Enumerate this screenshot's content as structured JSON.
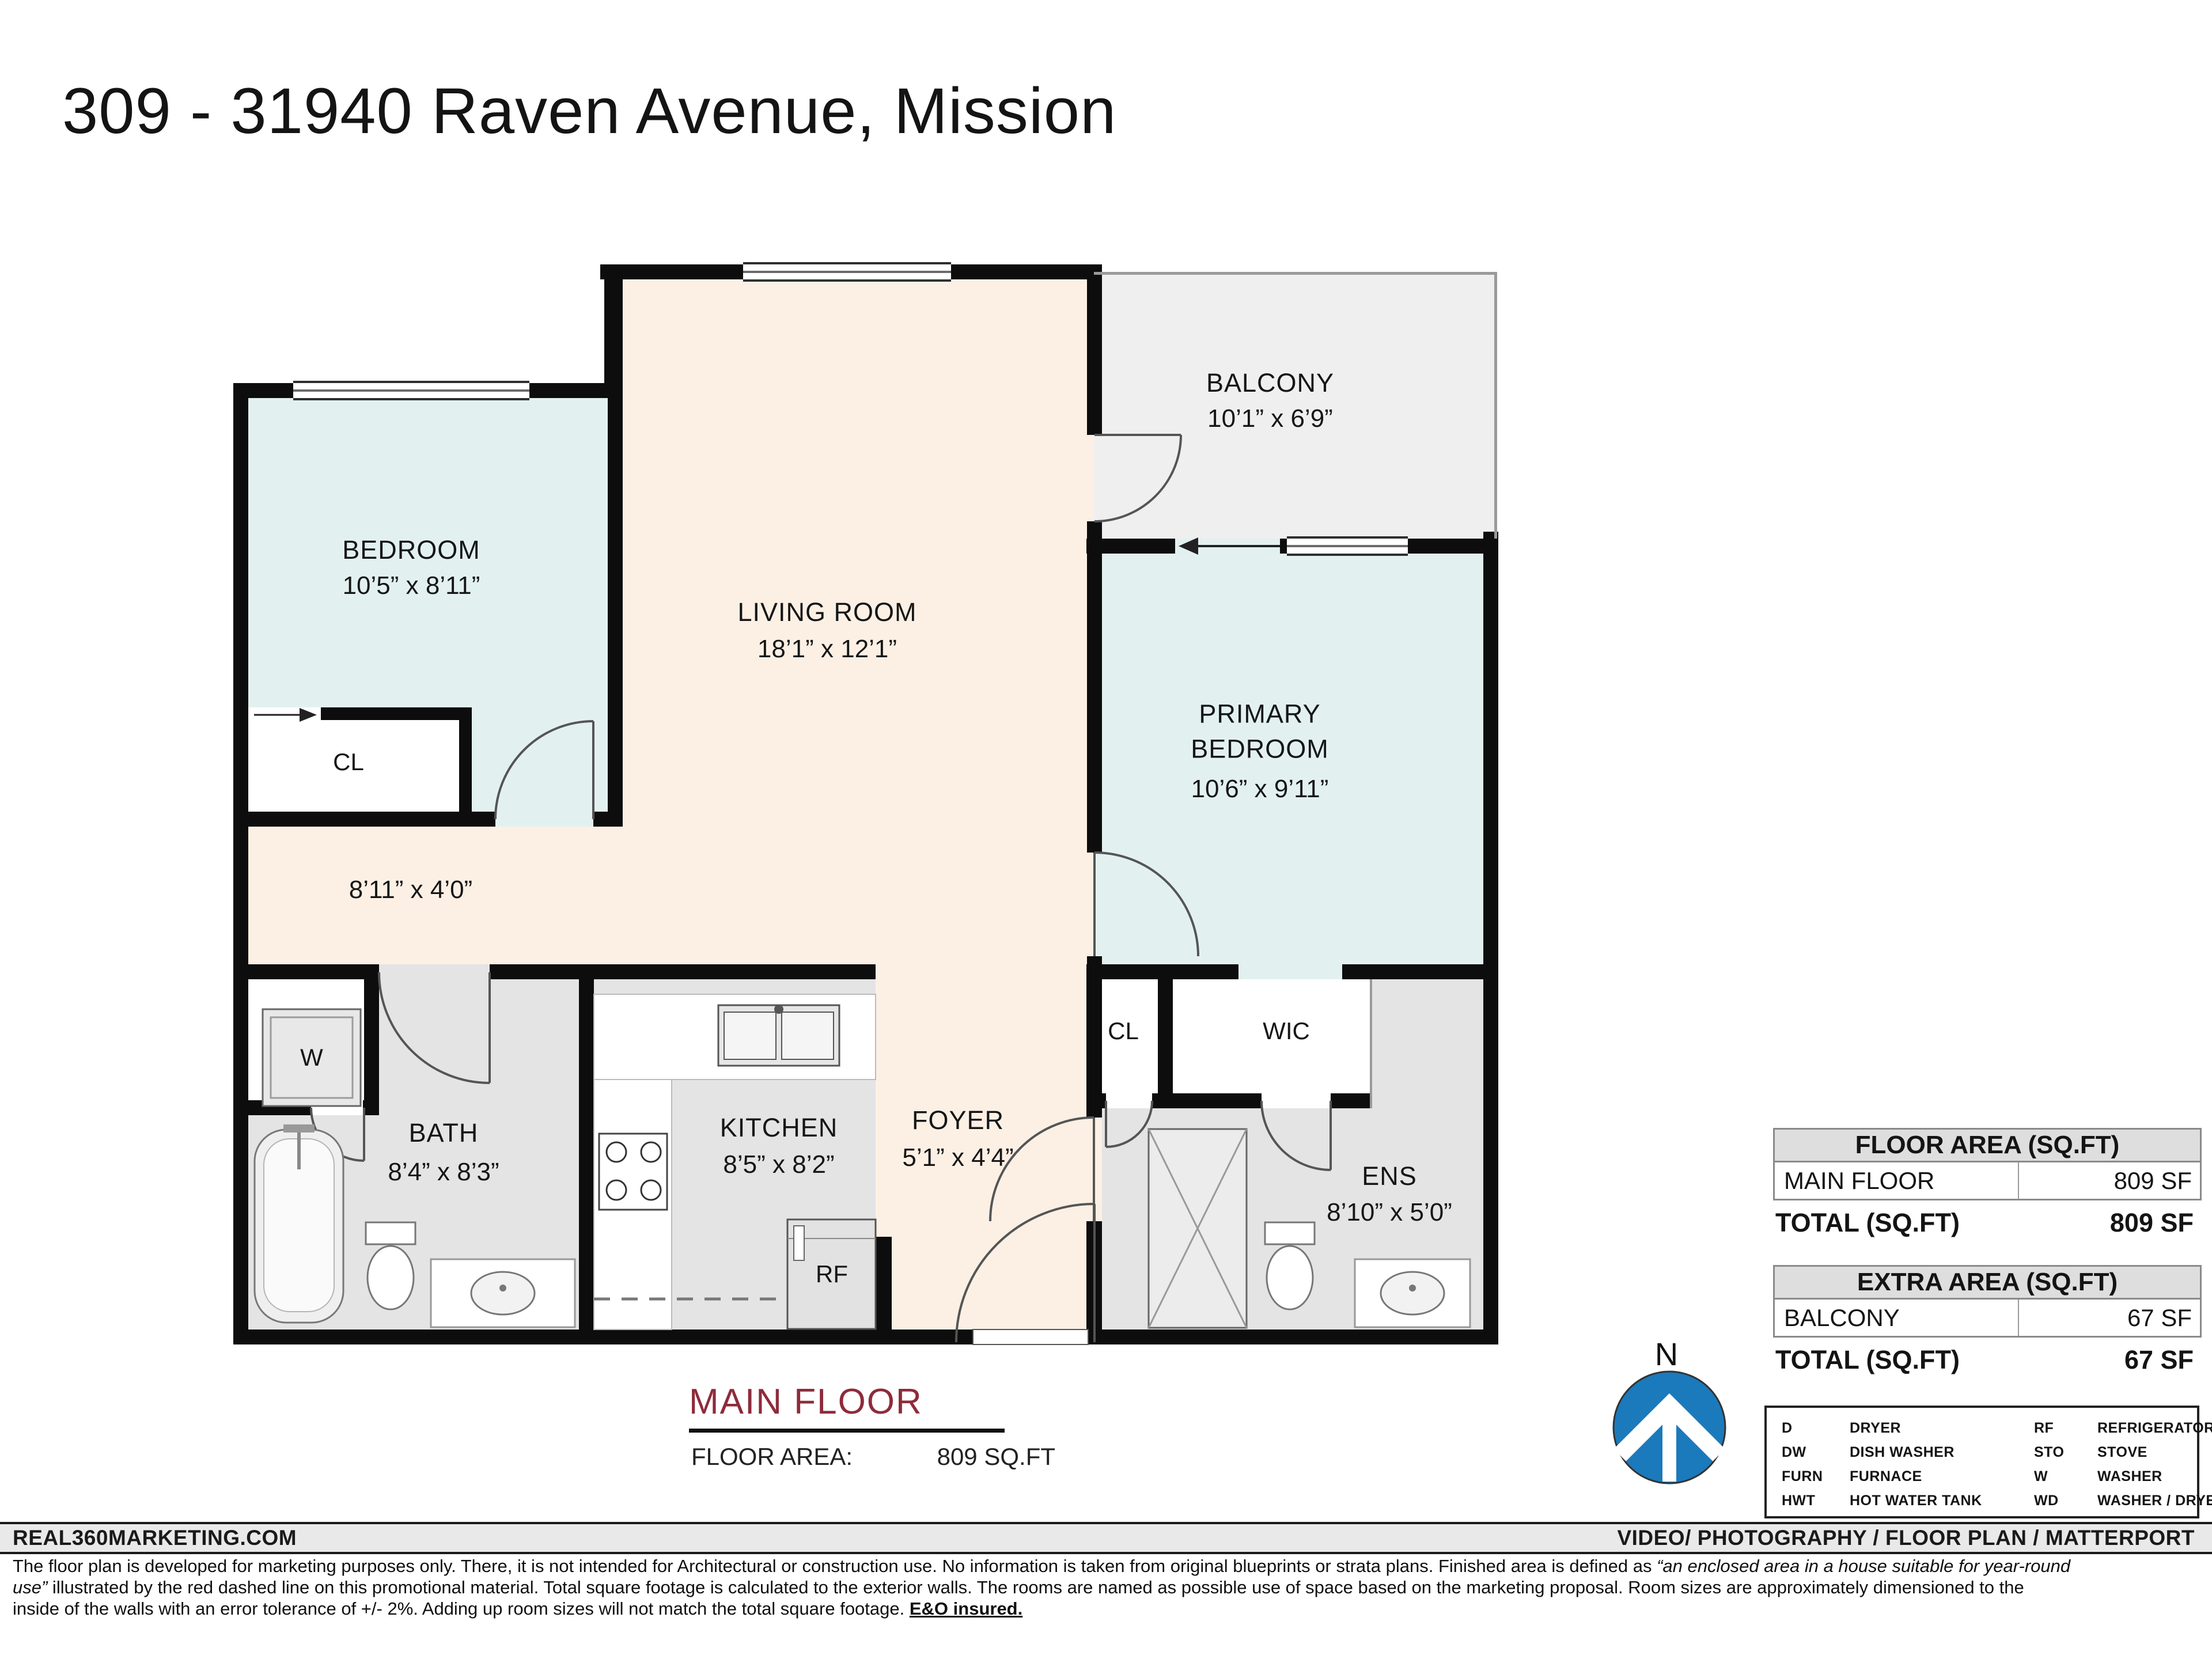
{
  "title": "309 - 31940 Raven  Avenue, Mission",
  "plan": {
    "rooms": [
      {
        "label": "BEDROOM",
        "dims": "10’5” x 8’11”"
      },
      {
        "label": "LIVING ROOM",
        "dims": "18’1” x 12’1”"
      },
      {
        "label": "BALCONY",
        "dims": "10’1” x 6’9”"
      },
      {
        "label": "PRIMARY BEDROOM",
        "dims": "10’6” x 9’11”"
      },
      {
        "label": "BATH",
        "dims": "8’4” x 8’3”"
      },
      {
        "label": "KITCHEN",
        "dims": "8’5” x 8’2”"
      },
      {
        "label": "FOYER",
        "dims": "5’1” x 4’4”"
      },
      {
        "label": "ENS",
        "dims": "8’10” x 5’0”"
      },
      {
        "label": "",
        "dims": "8’11” x 4’0”"
      }
    ],
    "small_labels": {
      "cl1": "CL",
      "cl2": "CL",
      "wic": "WIC",
      "washer": "W",
      "fridge": "RF"
    }
  },
  "floor_summary": {
    "name": "MAIN FLOOR",
    "area_label": "FLOOR AREA:",
    "area_value": "809 SQ.FT"
  },
  "area_tables": [
    {
      "header": "FLOOR AREA (SQ.FT)",
      "row_label": "MAIN FLOOR",
      "row_value": "809 SF",
      "total_label": "TOTAL (SQ.FT)",
      "total_value": "809 SF"
    },
    {
      "header": "EXTRA AREA (SQ.FT)",
      "row_label": "BALCONY",
      "row_value": "67 SF",
      "total_label": "TOTAL (SQ.FT)",
      "total_value": "67 SF"
    }
  ],
  "legend": {
    "rows": [
      {
        "abbr1": "D",
        "name1": "DRYER",
        "abbr2": "RF",
        "name2": "REFRIGERATOR"
      },
      {
        "abbr1": "DW",
        "name1": "DISH WASHER",
        "abbr2": "STO",
        "name2": "STOVE"
      },
      {
        "abbr1": "FURN",
        "name1": "FURNACE",
        "abbr2": "W",
        "name2": "WASHER"
      },
      {
        "abbr1": "HWT",
        "name1": "HOT WATER TANK",
        "abbr2": "WD",
        "name2": "WASHER / DRYER"
      }
    ]
  },
  "compass": {
    "label": "N"
  },
  "footer": {
    "left": "REAL360MARKETING.COM",
    "right": "VIDEO/ PHOTOGRAPHY / FLOOR PLAN / MATTERPORT"
  },
  "disclaimer": {
    "seg1": "The floor plan is developed for marketing purposes only. There, it is not intended for Architectural or construction use. No information is taken from original blueprints or strata plans. Finished area is defined as ",
    "seg2": "“an enclosed area in a house suitable for year-round use”",
    "seg3": " illustrated by the red dashed line on this promotional material. Total square footage is calculated to the exterior walls. The rooms are named as possible use of space based on the marketing proposal. Room sizes are approximately dimensioned to the inside of the walls with an error tolerance of +/- 2%. Adding up room sizes will not match the total square footage. ",
    "seg4": "E&O insured."
  },
  "colors": {
    "accent_maroon": "#8e2b3b",
    "compass_blue": "#1b7abc",
    "room_cream": "#fcf0e5",
    "room_cyan": "#e2f1f0",
    "room_grey": "#e4e4e4",
    "balcony_grey": "#efefef"
  }
}
